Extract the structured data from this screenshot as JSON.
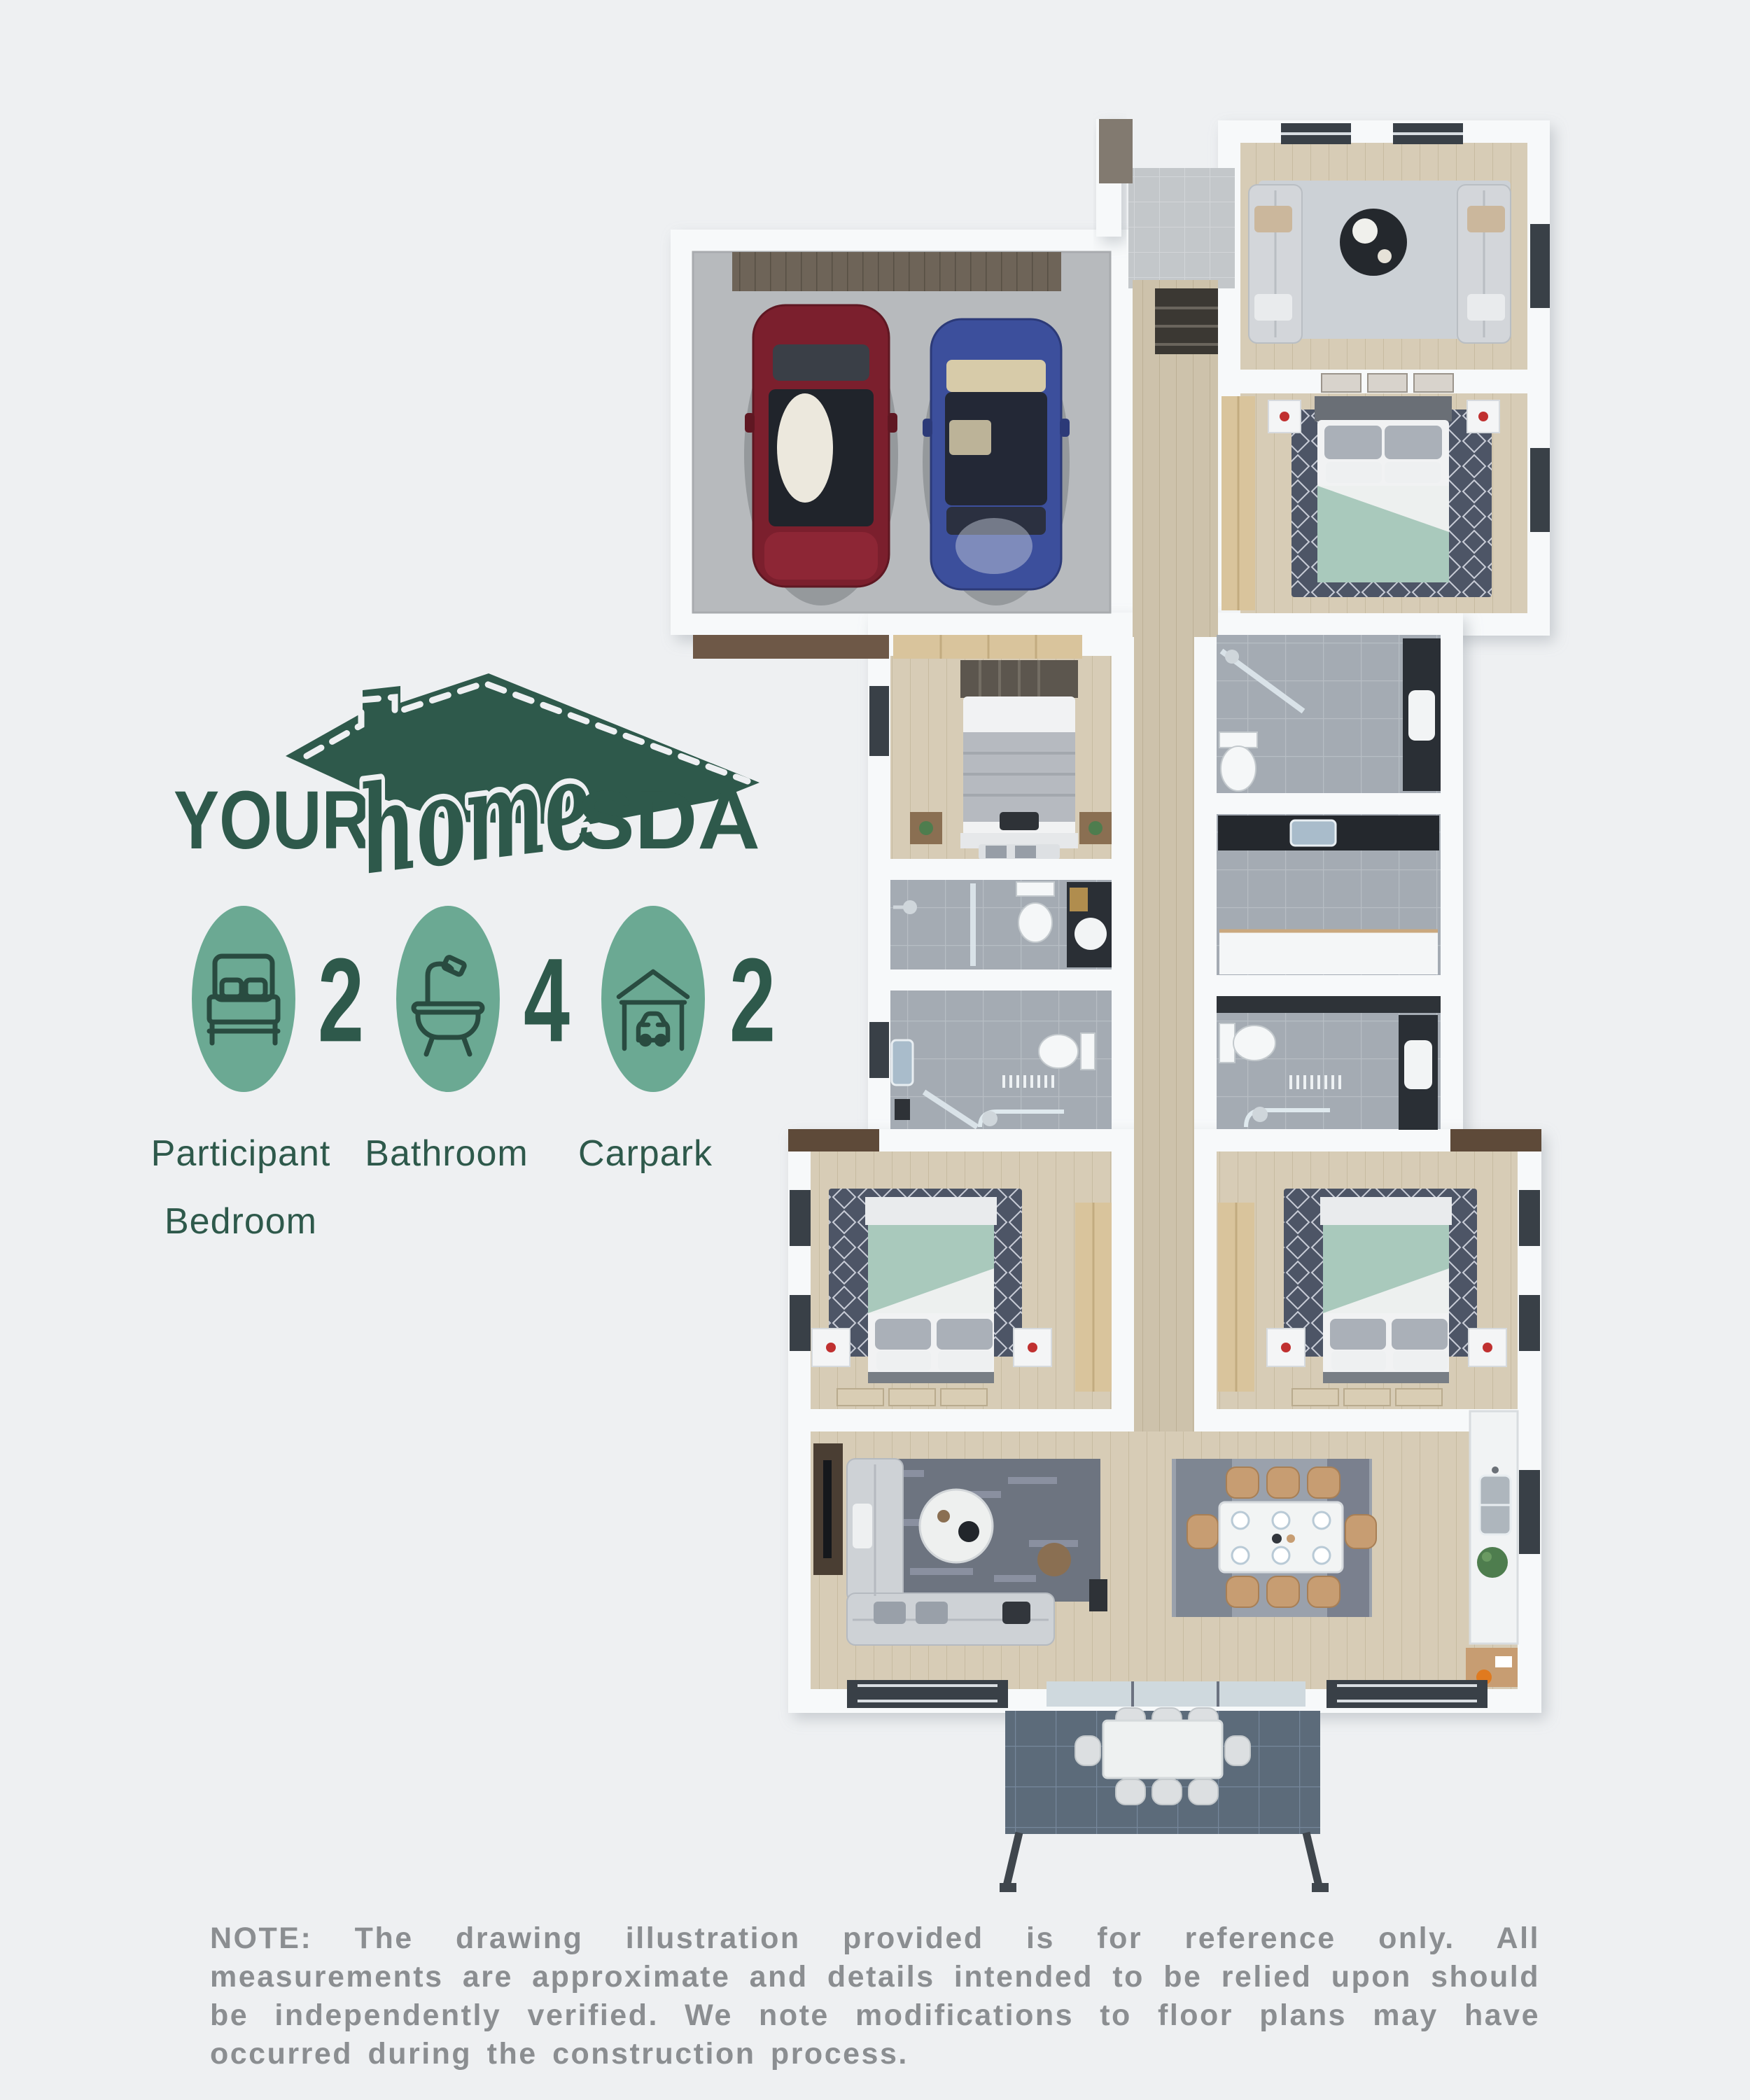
{
  "logo": {
    "your": "YOUR",
    "home": "home",
    "sda": "SDA"
  },
  "legend": {
    "items": [
      {
        "icon": "bed-icon",
        "count": "2",
        "label_lines": [
          "Participant",
          "Bedroom"
        ]
      },
      {
        "icon": "bathtub-icon",
        "count": "4",
        "label_lines": [
          "Bathroom"
        ]
      },
      {
        "icon": "carport-icon",
        "count": "2",
        "label_lines": [
          "Carpark"
        ]
      }
    ]
  },
  "note": {
    "text": "NOTE: The drawing illustration provided is for reference only. All measurements are approximate and details intended to be relied upon should be independently verified. We note modifications to floor plans may have occurred during the construction process."
  },
  "colors": {
    "brand_green": "#2e594b",
    "legend_circle_teal": "#6ba993",
    "icon_stroke": "#294b40",
    "note_gray": "#8b8e91",
    "page_background": "#eef0f2",
    "wall_white": "#f7f9fa",
    "wood_floor": "#d7ccb6",
    "hallway_wood": "#cdc2ab",
    "bathroom_tile": "#a4abb3",
    "concrete": "#b7babd",
    "alfresco_tile": "#5c6b7a",
    "car_red": "#7b1f2d",
    "car_blue": "#3c4f9c",
    "bed_teal": "#a9c9bc"
  },
  "floor_plan": {
    "rooms": [
      "garage",
      "entry",
      "living-room",
      "bedroom-1",
      "ensuite-bathroom",
      "laundry",
      "bathroom-2",
      "hallway",
      "bedroom-2",
      "bathroom-3",
      "bathroom-4",
      "bedroom-3",
      "bedroom-4",
      "open-plan-living-dining-kitchen",
      "alfresco-patio"
    ]
  }
}
